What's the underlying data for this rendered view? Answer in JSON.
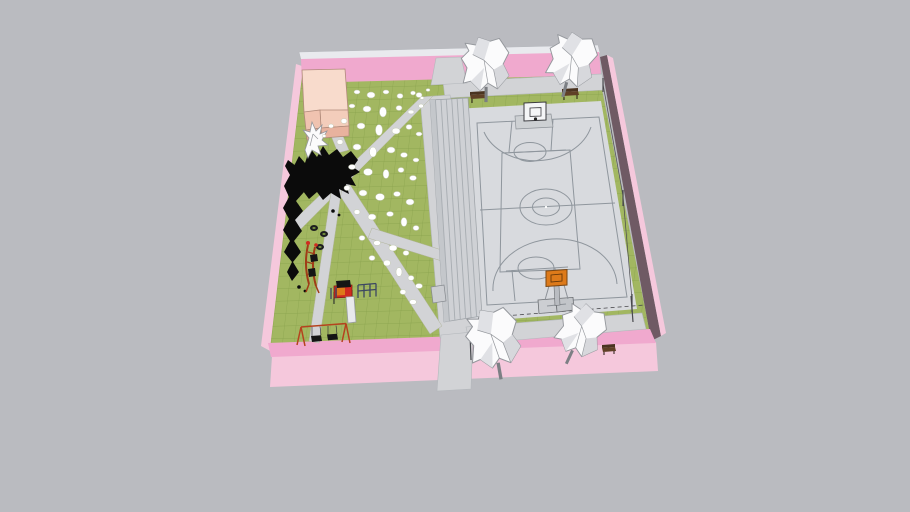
{
  "viewport": {
    "width": 910,
    "height": 512
  },
  "colors": {
    "background": "#babbc0",
    "wall_pink_top": "#f0a9ce",
    "wall_pink_light": "#f5c8dc",
    "wall_inner_dark": "#6f5a64",
    "wall_edge_light": "#e9eaee",
    "grass": "#a2b761",
    "grass_line": "#7f9a45",
    "path": "#d2d3d6",
    "court": "#d8dade",
    "court_line": "#8f969d",
    "bleacher": "#cfd1d5",
    "bleacher_line": "#a7acb1",
    "bleacher_side": "#c4c7cb",
    "building_roof": "#f8dbcc",
    "building_roof_low": "#f3cdbb",
    "building_face": "#e8b29e",
    "building_face_dark": "#e2ab96",
    "building_face_mid": "#f0c3b0",
    "tree_white": "#fbfbfc",
    "tree_shade": "#e0e1e5",
    "tree_shade2": "#d7d8dc",
    "tree_line": "#95989d",
    "tree_black": "#0b0b0b",
    "stone_fill": "#ffffff",
    "stone_edge": "#c2c8b2",
    "equip_red": "#cf2b20",
    "equip_dark_red": "#a03c17",
    "equip_black": "#151515",
    "equip_blue": "#3c4862",
    "slide_white": "#e8e9ec",
    "swing_orange": "#b5431e",
    "bench_brown": "#5f4026",
    "bench_back": "#4a3320",
    "hoop_orange": "#dd7a1a",
    "backboard_white": "#f4f5f7",
    "fence_dark": "#4a4a4e",
    "metal_gray": "#cdd0d3",
    "tire_hole": "#6f8a3c"
  },
  "scene": {
    "objects": [
      "perimeter-wall",
      "lawn",
      "pink-patio-strip",
      "service-building",
      "walkways",
      "bleachers",
      "basketball-court",
      "basketball-hoops",
      "white-trees",
      "black-shrub-tree",
      "white-stones",
      "benches",
      "swing-set",
      "slide-structure",
      "monkey-bars",
      "climber",
      "tires",
      "fence",
      "light-poles"
    ]
  }
}
